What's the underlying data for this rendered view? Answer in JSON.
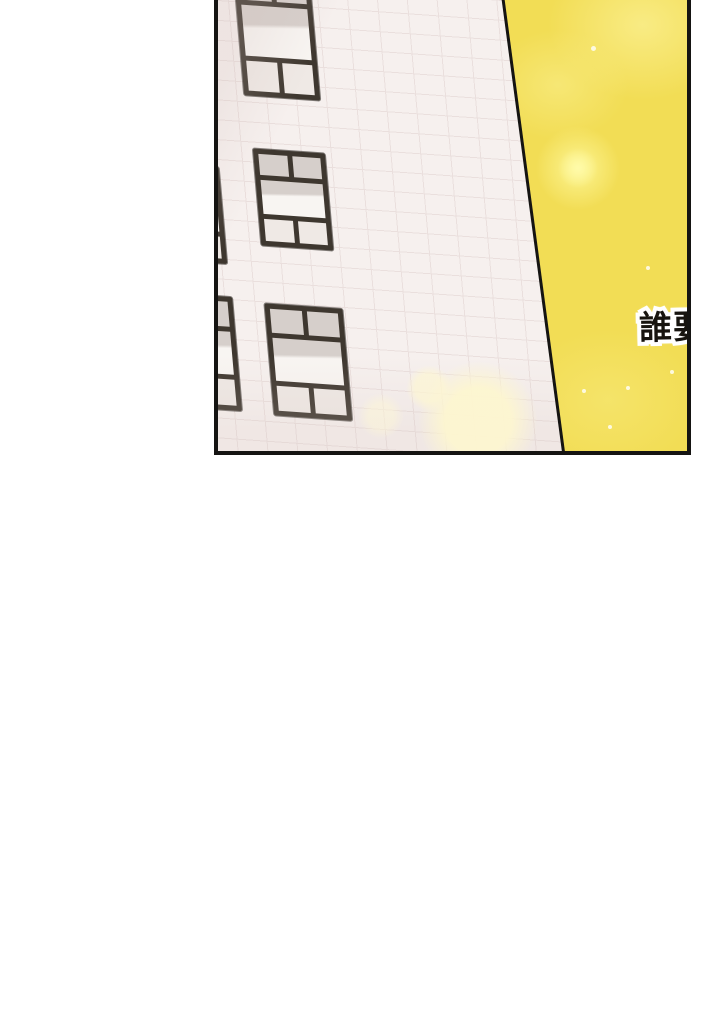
{
  "scene": {
    "kind": "webtoon-comic-panel",
    "caption": {
      "text": "誰要去網咖?"
    },
    "elements": {
      "building": "tilted light facade with dark framed windows",
      "sky": "bright yellow sky with soft clouds, light specks and lens glow"
    },
    "colors": {
      "page_bg": "#ffffff",
      "panel_border": "#151412",
      "facade": "#f6f0ee",
      "tile_line": "#e6dad8",
      "window_frame": "#3e372f",
      "pane_light": "#efe9e5",
      "pane_grey": "#d6cfcb",
      "sky_yellow": "#f2dd55",
      "sky_light": "#f9ee8a",
      "glow": "#fdf6d0",
      "caption_text": "#17140f",
      "caption_halo": "#ffffff"
    }
  }
}
